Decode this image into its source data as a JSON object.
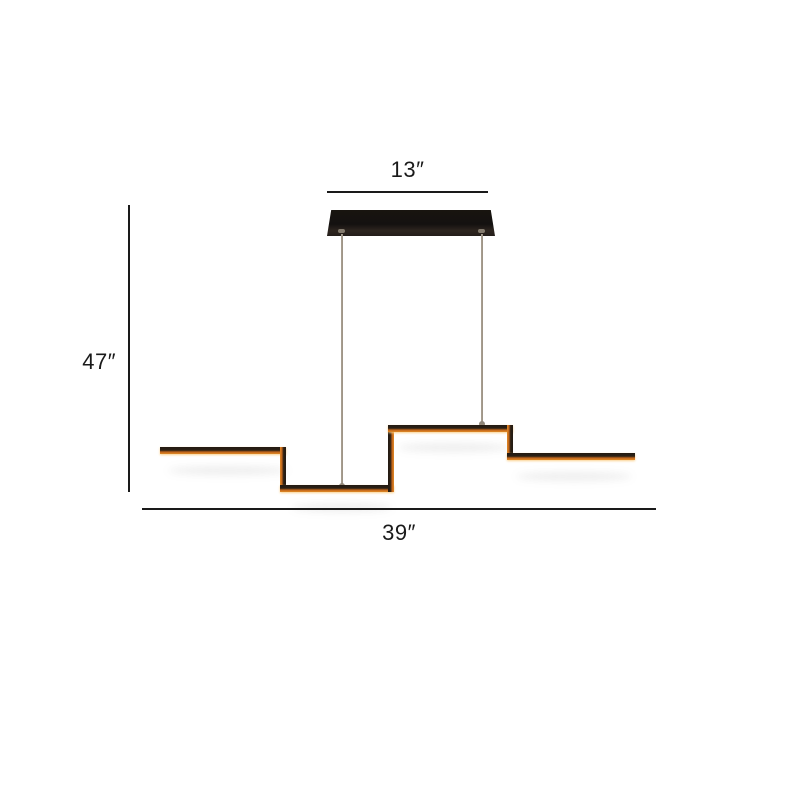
{
  "diagram": {
    "kind": "pendant-light-dimension-diagram",
    "dimensions": {
      "canopy_width": {
        "label": "13″"
      },
      "hanging_height": {
        "label": "47″"
      },
      "fixture_length": {
        "label": "39″"
      }
    }
  },
  "colors": {
    "background": "#ffffff",
    "text": "#1a1a1a",
    "dimension_line": "#1a1a1a",
    "canopy_dark": "#18140f",
    "canopy_light": "#2e2620",
    "cable": "#9b9184",
    "bar_dark": "#231a12",
    "bar_orange": "#c2661c",
    "bar_glow": "#f5a623"
  }
}
